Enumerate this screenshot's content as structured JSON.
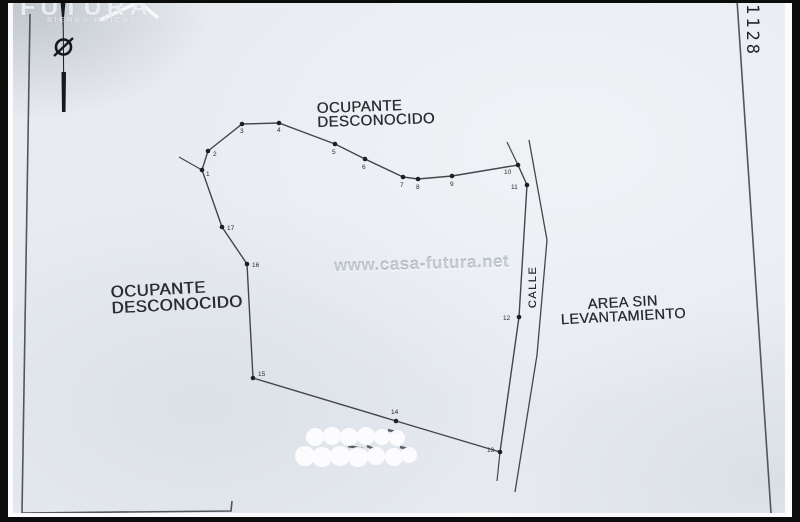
{
  "colors": {
    "paper": "#e8ecf1",
    "ink": "#43464b",
    "ink_dark": "#16181b",
    "text": "#2b2d31",
    "photo_edge": "#0c0c0d",
    "watermark": "#adb5c0",
    "logo": "#f8fafc"
  },
  "header": {
    "logo_title": "FUTURA",
    "logo_subtitle": "BIENES RAICES",
    "corner_number": "1128"
  },
  "watermark_text": "www.casa-futura.net",
  "labels": {
    "occupant_top_line1": "OCUPANTE",
    "occupant_top_line2": "DESCONOCIDO",
    "occupant_left_line1": "OCUPANTE",
    "occupant_left_line2": "DESCONOCIDO",
    "street": "CALLE",
    "area_line1": "AREA SIN",
    "area_line2": "LEVANTAMIENTO"
  },
  "plan": {
    "vertices": [
      {
        "n": "1",
        "x": 202,
        "y": 170,
        "lx": 206,
        "ly": 176
      },
      {
        "n": "2",
        "x": 208,
        "y": 151,
        "lx": 213,
        "ly": 156
      },
      {
        "n": "3",
        "x": 242,
        "y": 124,
        "lx": 240,
        "ly": 133
      },
      {
        "n": "4",
        "x": 279,
        "y": 123,
        "lx": 277,
        "ly": 132
      },
      {
        "n": "5",
        "x": 335,
        "y": 144,
        "lx": 332,
        "ly": 154
      },
      {
        "n": "6",
        "x": 365,
        "y": 159,
        "lx": 362,
        "ly": 169
      },
      {
        "n": "7",
        "x": 403,
        "y": 177,
        "lx": 400,
        "ly": 187
      },
      {
        "n": "8",
        "x": 418,
        "y": 179,
        "lx": 416,
        "ly": 189
      },
      {
        "n": "9",
        "x": 452,
        "y": 176,
        "lx": 450,
        "ly": 186
      },
      {
        "n": "10",
        "x": 518,
        "y": 165,
        "lx": 504,
        "ly": 174
      },
      {
        "n": "11",
        "x": 527,
        "y": 185,
        "lx": 511,
        "ly": 189
      },
      {
        "n": "12",
        "x": 519,
        "y": 317,
        "lx": 503,
        "ly": 320
      },
      {
        "n": "13",
        "x": 500,
        "y": 452,
        "lx": 487,
        "ly": 452
      },
      {
        "n": "14",
        "x": 396,
        "y": 421,
        "lx": 391,
        "ly": 414
      },
      {
        "n": "15",
        "x": 253,
        "y": 378,
        "lx": 258,
        "ly": 376
      },
      {
        "n": "16",
        "x": 247,
        "y": 264,
        "lx": 252,
        "ly": 267
      },
      {
        "n": "17",
        "x": 222,
        "y": 227,
        "lx": 227,
        "ly": 230
      }
    ],
    "extensions": [
      [
        202,
        170,
        179,
        157
      ],
      [
        518,
        165,
        507,
        142
      ],
      [
        500,
        452,
        497,
        481
      ]
    ],
    "street_right": [
      [
        529,
        140
      ],
      [
        547,
        240
      ],
      [
        537,
        355
      ],
      [
        515,
        492
      ]
    ],
    "frame": [
      [
        [
          30,
          14
        ],
        [
          22,
          513
        ]
      ],
      [
        [
          22,
          513
        ],
        [
          231,
          511
        ],
        [
          232,
          501
        ]
      ],
      [
        [
          737,
          0
        ],
        [
          771,
          513
        ]
      ]
    ],
    "north": {
      "x": 63,
      "top": 0,
      "bottom": 112,
      "circle_y": 47,
      "r": 7.5
    },
    "redaction": {
      "fragments": [
        [
          388,
          430,
          399,
          433
        ],
        [
          348,
          446,
          363,
          449
        ],
        [
          400,
          447,
          413,
          450
        ],
        [
          299,
          449,
          308,
          452
        ],
        [
          367,
          446,
          374,
          449
        ]
      ],
      "blobs": [
        [
          315,
          437,
          9
        ],
        [
          332,
          436,
          9
        ],
        [
          349,
          437,
          9
        ],
        [
          366,
          436,
          9
        ],
        [
          382,
          437,
          8
        ],
        [
          397,
          438,
          8
        ],
        [
          305,
          456,
          10
        ],
        [
          322,
          457,
          10
        ],
        [
          340,
          456,
          10
        ],
        [
          358,
          457,
          10
        ],
        [
          376,
          456,
          9
        ],
        [
          394,
          457,
          9
        ],
        [
          409,
          455,
          8
        ]
      ]
    }
  }
}
